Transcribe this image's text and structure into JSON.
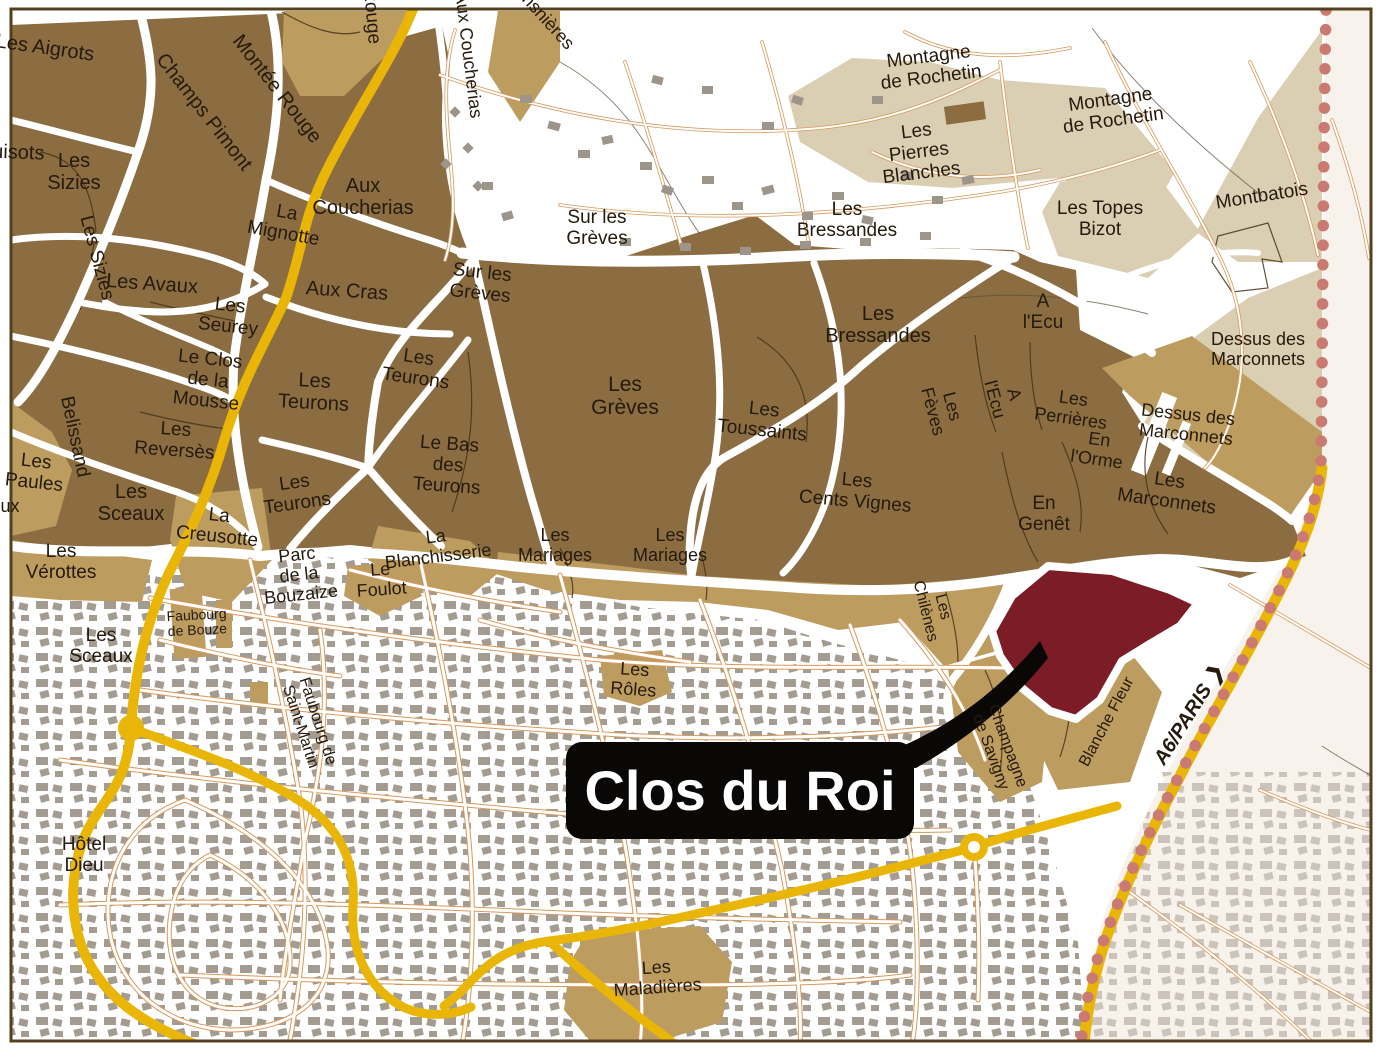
{
  "map": {
    "type": "vineyard-parcel-map",
    "callout": {
      "text": "Clos du Roi",
      "x": 566,
      "y": 742,
      "w": 348,
      "h": 97
    },
    "colors": {
      "premier_cru_brown": "#8b6d41",
      "village_tan": "#bd9c60",
      "light_beige": "#dbcfb3",
      "city_building_gray": "#a49b91",
      "pale_outside": "#f8f2ec",
      "pale_building_gray": "#ccc4ba",
      "road_yellow": "#e9b607",
      "street_orange": "#d6995c",
      "boundary_dots_red": "#ca7a71",
      "highlight_maroon": "#7b1c27",
      "callout_black": "#0a0806",
      "label_dark": "#241a0d",
      "frame_brown": "#53411d"
    },
    "labels": [
      {
        "id": "les-aigrots",
        "text": "Les Aigrots",
        "x": 45,
        "y": 48,
        "rot": 8,
        "fs": 20
      },
      {
        "id": "champs-pimont",
        "text": "Champs Pimont",
        "x": 204,
        "y": 112,
        "rot": 52,
        "fs": 20
      },
      {
        "id": "montee-rouge",
        "text": "Montée Rouge",
        "x": 277,
        "y": 89,
        "rot": 52,
        "fs": 20
      },
      {
        "id": "montee-rouge-2",
        "text": "Montée Rouge",
        "x": 368,
        "y": -18,
        "rot": 85,
        "fs": 19,
        "clipped": true
      },
      {
        "id": "pertuisots",
        "text": "Pertuisots",
        "x": 0,
        "y": 152,
        "rot": 2,
        "fs": 20,
        "clipped": true
      },
      {
        "id": "les-sizies",
        "lines": [
          "Les",
          "Sizies"
        ],
        "x": 74,
        "y": 172,
        "rot": 0,
        "fs": 20
      },
      {
        "id": "les-sizies-2",
        "text": "Les Sizies",
        "x": 96,
        "y": 258,
        "rot": 75,
        "fs": 19
      },
      {
        "id": "les-avaux",
        "text": "Les Avaux",
        "x": 152,
        "y": 284,
        "rot": 4,
        "fs": 20
      },
      {
        "id": "les-seurey",
        "lines": [
          "Les",
          "Seurey"
        ],
        "x": 229,
        "y": 317,
        "rot": 6,
        "fs": 19
      },
      {
        "id": "la-mignotte",
        "lines": [
          "La",
          "Mignotte"
        ],
        "x": 285,
        "y": 224,
        "rot": 10,
        "fs": 19
      },
      {
        "id": "aux-coucherias",
        "lines": [
          "Aux",
          "Coucherias"
        ],
        "x": 363,
        "y": 197,
        "rot": 0,
        "fs": 20
      },
      {
        "id": "aux-coucherias-2",
        "text": "Aux Coucherias",
        "x": 468,
        "y": 55,
        "rot": 83,
        "fs": 18,
        "clipped": true
      },
      {
        "id": "les-monsnieres",
        "text": "Les Monsnières",
        "x": 528,
        "y": 0,
        "rot": 48,
        "fs": 18,
        "clipped": true
      },
      {
        "id": "aux-cras",
        "text": "Aux Cras",
        "x": 347,
        "y": 291,
        "rot": 4,
        "fs": 20
      },
      {
        "id": "sur-les-greves",
        "lines": [
          "Sur les",
          "Grèves"
        ],
        "x": 481,
        "y": 284,
        "rot": 6,
        "fs": 19
      },
      {
        "id": "sur-les-greves-2",
        "lines": [
          "Sur les",
          "Grèves"
        ],
        "x": 597,
        "y": 229,
        "rot": 0,
        "fs": 19
      },
      {
        "id": "les-teurons",
        "lines": [
          "Les",
          "Teurons"
        ],
        "x": 314,
        "y": 392,
        "rot": 3,
        "fs": 20
      },
      {
        "id": "les-teurons-2",
        "lines": [
          "Les",
          "Teurons"
        ],
        "x": 417,
        "y": 369,
        "rot": 8,
        "fs": 19
      },
      {
        "id": "le-bas-des-teurons",
        "lines": [
          "Le Bas",
          "des",
          "Teurons"
        ],
        "x": 448,
        "y": 466,
        "rot": 4,
        "fs": 19
      },
      {
        "id": "les-teurons-3",
        "lines": [
          "Les",
          "Teurons"
        ],
        "x": 296,
        "y": 494,
        "rot": -8,
        "fs": 19
      },
      {
        "id": "le-clos-de-la-mousse",
        "lines": [
          "Le Clos",
          "de la",
          "Mousse"
        ],
        "x": 208,
        "y": 381,
        "rot": 6,
        "fs": 19
      },
      {
        "id": "belissand",
        "text": "Belissand",
        "x": 74,
        "y": 437,
        "rot": 78,
        "fs": 19
      },
      {
        "id": "les-reverses",
        "lines": [
          "Les",
          "Reversès"
        ],
        "x": 175,
        "y": 441,
        "rot": 4,
        "fs": 19
      },
      {
        "id": "les-paules",
        "lines": [
          "Les",
          "Paules"
        ],
        "x": 35,
        "y": 473,
        "rot": 6,
        "fs": 19
      },
      {
        "id": "les-chouacheux",
        "text": "Les Chouacheux",
        "x": -48,
        "y": 507,
        "rot": 0,
        "fs": 18,
        "clipped": true
      },
      {
        "id": "les-sceaux",
        "lines": [
          "Les",
          "Sceaux"
        ],
        "x": 131,
        "y": 503,
        "rot": 0,
        "fs": 20
      },
      {
        "id": "la-creusotte",
        "lines": [
          "La",
          "Creusotte"
        ],
        "x": 218,
        "y": 527,
        "rot": 6,
        "fs": 19
      },
      {
        "id": "les-verottes",
        "lines": [
          "Les",
          "Vérottes"
        ],
        "x": 61,
        "y": 563,
        "rot": 0,
        "fs": 19
      },
      {
        "id": "les-greves",
        "lines": [
          "Les",
          "Grèves"
        ],
        "x": 625,
        "y": 396,
        "rot": 0,
        "fs": 21
      },
      {
        "id": "les-toussaints",
        "lines": [
          "Les",
          "Toussaints"
        ],
        "x": 763,
        "y": 421,
        "rot": 6,
        "fs": 19
      },
      {
        "id": "les-bressandes",
        "lines": [
          "Les",
          "Bressandes"
        ],
        "x": 847,
        "y": 221,
        "rot": 0,
        "fs": 19
      },
      {
        "id": "les-bressandes-2",
        "lines": [
          "Les",
          "Bressandes"
        ],
        "x": 878,
        "y": 325,
        "rot": 0,
        "fs": 20
      },
      {
        "id": "les-cents-vignes",
        "lines": [
          "Les",
          "Cents Vignes"
        ],
        "x": 856,
        "y": 492,
        "rot": 5,
        "fs": 19
      },
      {
        "id": "les-feves",
        "lines": [
          "Les",
          "Fèves"
        ],
        "x": 942,
        "y": 409,
        "rot": 75,
        "fs": 18
      },
      {
        "id": "a-lecu",
        "lines": [
          "A",
          "l'Ecu"
        ],
        "x": 1043,
        "y": 313,
        "rot": 0,
        "fs": 19
      },
      {
        "id": "a-lecu-2",
        "lines": [
          "A",
          "l'Ecu"
        ],
        "x": 1004,
        "y": 397,
        "rot": 75,
        "fs": 18
      },
      {
        "id": "les-perrieres",
        "lines": [
          "Les",
          "Perrières"
        ],
        "x": 1072,
        "y": 409,
        "rot": 8,
        "fs": 18
      },
      {
        "id": "en-lorme",
        "lines": [
          "En",
          "l'Orme"
        ],
        "x": 1098,
        "y": 450,
        "rot": 8,
        "fs": 18
      },
      {
        "id": "en-genet",
        "lines": [
          "En",
          "Genêt"
        ],
        "x": 1044,
        "y": 515,
        "rot": 0,
        "fs": 19
      },
      {
        "id": "les-marconnets",
        "lines": [
          "Les",
          "Marconnets"
        ],
        "x": 1168,
        "y": 492,
        "rot": 8,
        "fs": 19
      },
      {
        "id": "dessus-des-marconnets",
        "lines": [
          "Dessus des",
          "Marconnets"
        ],
        "x": 1187,
        "y": 425,
        "rot": 6,
        "fs": 18
      },
      {
        "id": "dessus-des-marconnets-2",
        "lines": [
          "Dessus des",
          "Marconnets"
        ],
        "x": 1258,
        "y": 350,
        "rot": 0,
        "fs": 18
      },
      {
        "id": "montbatois",
        "text": "Montbatois",
        "x": 1262,
        "y": 197,
        "rot": -9,
        "fs": 19
      },
      {
        "id": "montagne-de-rochetin",
        "lines": [
          "Montagne",
          "de Rochetin"
        ],
        "x": 930,
        "y": 68,
        "rot": -7,
        "fs": 19
      },
      {
        "id": "montagne-de-rochetin-2",
        "lines": [
          "Montagne",
          "de Rochetin"
        ],
        "x": 1112,
        "y": 111,
        "rot": -8,
        "fs": 19
      },
      {
        "id": "les-pierres-blanches",
        "lines": [
          "Les",
          "Pierres",
          "Blanches"
        ],
        "x": 919,
        "y": 153,
        "rot": -7,
        "fs": 19
      },
      {
        "id": "les-topes-bizot",
        "lines": [
          "Les Topes",
          "Bizot"
        ],
        "x": 1100,
        "y": 220,
        "rot": 0,
        "fs": 19
      },
      {
        "id": "la-blanchisserie",
        "lines": [
          "La",
          "Blanchisserie"
        ],
        "x": 437,
        "y": 547,
        "rot": -7,
        "fs": 18
      },
      {
        "id": "les-mariages",
        "lines": [
          "Les",
          "Mariages"
        ],
        "x": 555,
        "y": 546,
        "rot": 0,
        "fs": 18
      },
      {
        "id": "les-mariages-2",
        "lines": [
          "Les",
          "Mariages"
        ],
        "x": 670,
        "y": 546,
        "rot": 0,
        "fs": 18
      },
      {
        "id": "le-foulot",
        "lines": [
          "Le",
          "Foulot"
        ],
        "x": 381,
        "y": 580,
        "rot": -4,
        "fs": 18
      },
      {
        "id": "parc-de-la-bouzaize",
        "lines": [
          "Parc",
          "de la",
          "Bouzaize"
        ],
        "x": 299,
        "y": 575,
        "rot": -6,
        "fs": 18
      },
      {
        "id": "faubourg-de-bouze",
        "lines": [
          "Faubourg",
          "de Bouze"
        ],
        "x": 197,
        "y": 623,
        "rot": -3,
        "fs": 14
      },
      {
        "id": "les-sceaux-city",
        "lines": [
          "Les",
          "Sceaux"
        ],
        "x": 101,
        "y": 647,
        "rot": 0,
        "fs": 19
      },
      {
        "id": "faubourg-de-saint-martin",
        "lines": [
          "Faubourg de",
          "Saint-Martin"
        ],
        "x": 309,
        "y": 724,
        "rot": 72,
        "fs": 16
      },
      {
        "id": "hotel-dieu",
        "lines": [
          "Hôtel",
          "Dieu"
        ],
        "x": 84,
        "y": 856,
        "rot": 0,
        "fs": 19
      },
      {
        "id": "les-roles",
        "lines": [
          "Les",
          "Rôles"
        ],
        "x": 634,
        "y": 680,
        "rot": 4,
        "fs": 18
      },
      {
        "id": "les-chilenes",
        "lines": [
          "Les",
          "Chilènes"
        ],
        "x": 934,
        "y": 609,
        "rot": 76,
        "fs": 16
      },
      {
        "id": "champagne-de-savigny",
        "lines": [
          "Champagne",
          "de Savigny"
        ],
        "x": 999,
        "y": 749,
        "rot": 70,
        "fs": 16
      },
      {
        "id": "blanche-fleur",
        "text": "Blanche Fleur",
        "x": 1107,
        "y": 722,
        "rot": -62,
        "fs": 16
      },
      {
        "id": "a6-paris",
        "text": "A6/PARIS ❯",
        "x": 1189,
        "y": 715,
        "rot": -58,
        "fs": 20,
        "bold": true,
        "italic": true
      },
      {
        "id": "les-maladieres",
        "lines": [
          "Les",
          "Maladières"
        ],
        "x": 657,
        "y": 978,
        "rot": -4,
        "fs": 18
      }
    ]
  }
}
